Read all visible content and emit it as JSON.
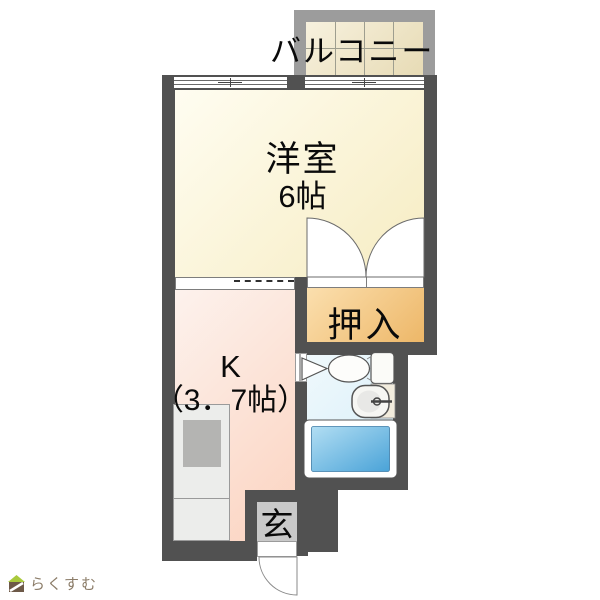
{
  "plan": {
    "balcony": {
      "label": "バルコニー"
    },
    "western_room": {
      "label": "洋室",
      "size": "6帖"
    },
    "closet": {
      "label": "押入"
    },
    "kitchen": {
      "label": "K",
      "size": "（3．7帖）"
    },
    "entrance": {
      "label": "玄"
    }
  },
  "fixtures": {
    "bathroom": [
      "toilet",
      "sink",
      "bathtub"
    ],
    "kitchen": [
      "kitchen-counter",
      "kitchen-sink"
    ]
  },
  "logo": {
    "text": "らくすむ"
  },
  "colors": {
    "wall": "#515151",
    "western_room_floor": "#f6ecc2",
    "closet_floor": "#edb768",
    "kitchen_floor": "#fbd3c0",
    "bathroom_floor": "#d7eef9",
    "bathtub": "#4aa3d8",
    "balcony_deck": "#e7dbb5",
    "balcony_rail": "#9c9c9c",
    "entrance_tile": "#c9c9c9",
    "logo_text": "#8b7c68",
    "logo_roof": "#a9c93c",
    "logo_body": "#6d5948"
  }
}
